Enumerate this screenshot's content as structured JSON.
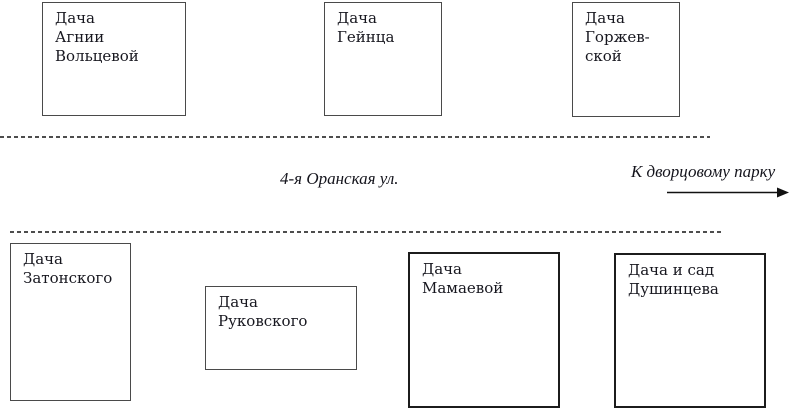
{
  "colors": {
    "background": "#ffffff",
    "text": "#17171f",
    "box_border": "#4a4a4a",
    "street_dash": "#4d4d4d",
    "arrow": "#111111"
  },
  "street": {
    "name": "4-я Оранская ул.",
    "direction": "К дворцовому парку",
    "direction_icon": "right-arrow-icon"
  },
  "north_side": {
    "boxes": [
      {
        "label": "Дача\nАгнии\nВольцевой"
      },
      {
        "label": "Дача\nГейнца"
      },
      {
        "label": "Дача\nГоржев-\nской"
      }
    ]
  },
  "south_side": {
    "boxes": [
      {
        "label": "Дача\nЗатонского"
      },
      {
        "label": "Дача\nРуковского"
      },
      {
        "label": "Дача\nМамаевой"
      },
      {
        "label": "Дача и сад\nДушинцева"
      }
    ]
  }
}
